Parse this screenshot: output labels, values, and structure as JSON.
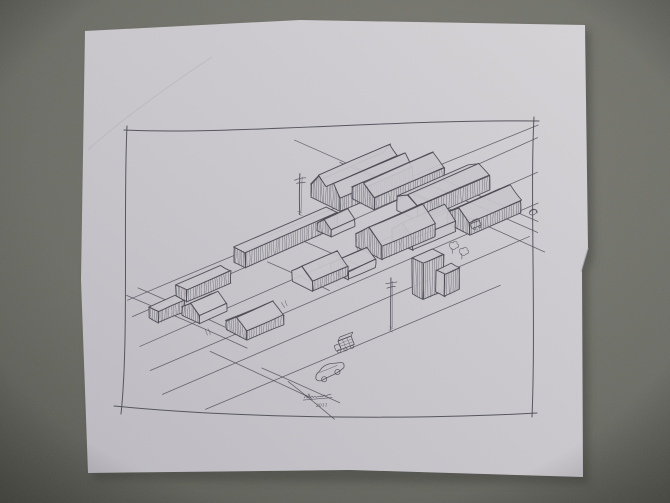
{
  "scene": {
    "kind": "photo of hand-drawn architectural sketch on paper",
    "background_color": "#6b6b64",
    "background_edge": "#4e4f46",
    "paper_color": "#cac7cd",
    "paper_light": "#d8d5d9",
    "paper_dark": "#bdbac2",
    "ink_color": "#42414b"
  },
  "sketch": {
    "subject": "axonometric study of a city block: gabled halls, row houses, slab buildings, streets, utility poles, cars",
    "signature_name": "(illegible signature)",
    "signature_year": "2011",
    "border": {
      "tl": [
        126,
        129
      ],
      "tr": [
        534,
        121
      ],
      "br": [
        533,
        415
      ],
      "bl": [
        123,
        408
      ]
    },
    "streets": {
      "u_lines": [
        [
          266,
          236,
          538,
          125
        ],
        [
          133,
          316,
          538,
          138
        ],
        [
          140,
          347,
          538,
          172
        ],
        [
          150,
          371,
          538,
          203
        ],
        [
          163,
          394,
          530,
          237
        ],
        [
          205,
          409,
          500,
          285
        ],
        [
          128,
          300,
          270,
          241
        ]
      ],
      "v_lines": [
        [
          294,
          140,
          545,
          252
        ],
        [
          340,
          162,
          470,
          220
        ],
        [
          410,
          176,
          538,
          233
        ],
        [
          430,
          174,
          538,
          222
        ],
        [
          127,
          295,
          247,
          348
        ],
        [
          138,
          288,
          225,
          327
        ],
        [
          210,
          352,
          312,
          398
        ],
        [
          262,
          368,
          340,
          403
        ],
        [
          288,
          382,
          334,
          419
        ],
        [
          300,
          240,
          360,
          266
        ],
        [
          268,
          262,
          330,
          290
        ]
      ]
    },
    "ticks": [
      [
        318,
        262
      ],
      [
        356,
        246
      ],
      [
        398,
        228
      ],
      [
        205,
        330
      ],
      [
        236,
        318
      ],
      [
        448,
        212
      ],
      [
        282,
        302
      ]
    ],
    "buildings": [
      {
        "id": "hall-a",
        "type": "gable2",
        "x": 311,
        "y": 197,
        "len": 78,
        "wid": 34,
        "wall": 13,
        "roof": 12,
        "hatch": [
          "end",
          "near"
        ]
      },
      {
        "id": "hall-b",
        "type": "gable",
        "x": 352,
        "y": 199,
        "len": 76,
        "wid": 26,
        "wall": 12,
        "roof": 10,
        "hatch": [
          "end",
          "near"
        ]
      },
      {
        "id": "hall-c",
        "type": "gable",
        "x": 397,
        "y": 211,
        "len": 78,
        "wid": 24,
        "wall": 15,
        "roof": 6,
        "hatch": [
          "near"
        ]
      },
      {
        "id": "hall-d",
        "type": "gable",
        "x": 447,
        "y": 224,
        "len": 56,
        "wid": 26,
        "wall": 12,
        "roof": 10,
        "hatch": [
          "end",
          "near"
        ]
      },
      {
        "id": "slab-long",
        "type": "flat",
        "x": 234,
        "y": 262,
        "len": 100,
        "wid": 13,
        "wall": 15,
        "hatch": [
          "near",
          "end"
        ]
      },
      {
        "id": "slab-cap",
        "type": "gable",
        "x": 317,
        "y": 230,
        "len": 26,
        "wid": 16,
        "wall": 7,
        "roof": 7,
        "hatch": [
          "end"
        ]
      },
      {
        "id": "mid-gable-b",
        "type": "gable",
        "x": 392,
        "y": 240,
        "len": 46,
        "wid": 24,
        "wall": 11,
        "roof": 11,
        "hatch": [
          "end"
        ]
      },
      {
        "id": "mid-gable-a",
        "type": "gable",
        "x": 356,
        "y": 247,
        "len": 58,
        "wid": 30,
        "wall": 13,
        "roof": 13,
        "hatch": [
          "end",
          "near"
        ]
      },
      {
        "id": "house-c",
        "type": "gable",
        "x": 331,
        "y": 271,
        "len": 30,
        "wid": 20,
        "wall": 8,
        "roof": 8,
        "hatch": [
          "end"
        ]
      },
      {
        "id": "house-d",
        "type": "gable",
        "x": 292,
        "y": 281,
        "len": 38,
        "wid": 24,
        "wall": 10,
        "roof": 10,
        "hatch": [
          "near"
        ]
      },
      {
        "id": "tower-a",
        "type": "flat",
        "x": 412,
        "y": 294,
        "len": 22,
        "wid": 13,
        "wall": 36,
        "hatch": [
          "near",
          "end"
        ]
      },
      {
        "id": "tower-b",
        "type": "flat",
        "x": 436,
        "y": 292,
        "len": 16,
        "wid": 10,
        "wall": 22,
        "hatch": [
          "near"
        ]
      },
      {
        "id": "front-slab",
        "type": "flat",
        "x": 176,
        "y": 297,
        "len": 48,
        "wid": 12,
        "wall": 12,
        "hatch": [
          "near",
          "end"
        ]
      },
      {
        "id": "front-box",
        "type": "flat",
        "x": 149,
        "y": 318,
        "len": 28,
        "wid": 11,
        "wall": 11,
        "hatch": [
          "near",
          "end"
        ]
      },
      {
        "id": "house-a",
        "type": "gable",
        "x": 182,
        "y": 315,
        "len": 30,
        "wid": 20,
        "wall": 8,
        "roof": 8,
        "hatch": [
          "end"
        ]
      },
      {
        "id": "house-b",
        "type": "gable",
        "x": 226,
        "y": 330,
        "len": 40,
        "wid": 24,
        "wall": 9,
        "roof": 9,
        "hatch": [
          "end",
          "near"
        ]
      }
    ],
    "props": [
      {
        "kind": "pole",
        "x": 391,
        "y": 330,
        "h": 52
      },
      {
        "kind": "pole",
        "x": 300,
        "y": 214,
        "h": 40
      },
      {
        "kind": "tree",
        "x": 450,
        "y": 247
      },
      {
        "kind": "tree",
        "x": 460,
        "y": 253
      },
      {
        "kind": "loop",
        "x": 530,
        "y": 212
      },
      {
        "kind": "sedan",
        "x": 313,
        "y": 371,
        "rot": -21
      },
      {
        "kind": "truck",
        "x": 338,
        "y": 341,
        "rot": -21
      },
      {
        "kind": "mini",
        "x": 470,
        "y": 224,
        "rot": -21
      }
    ]
  }
}
